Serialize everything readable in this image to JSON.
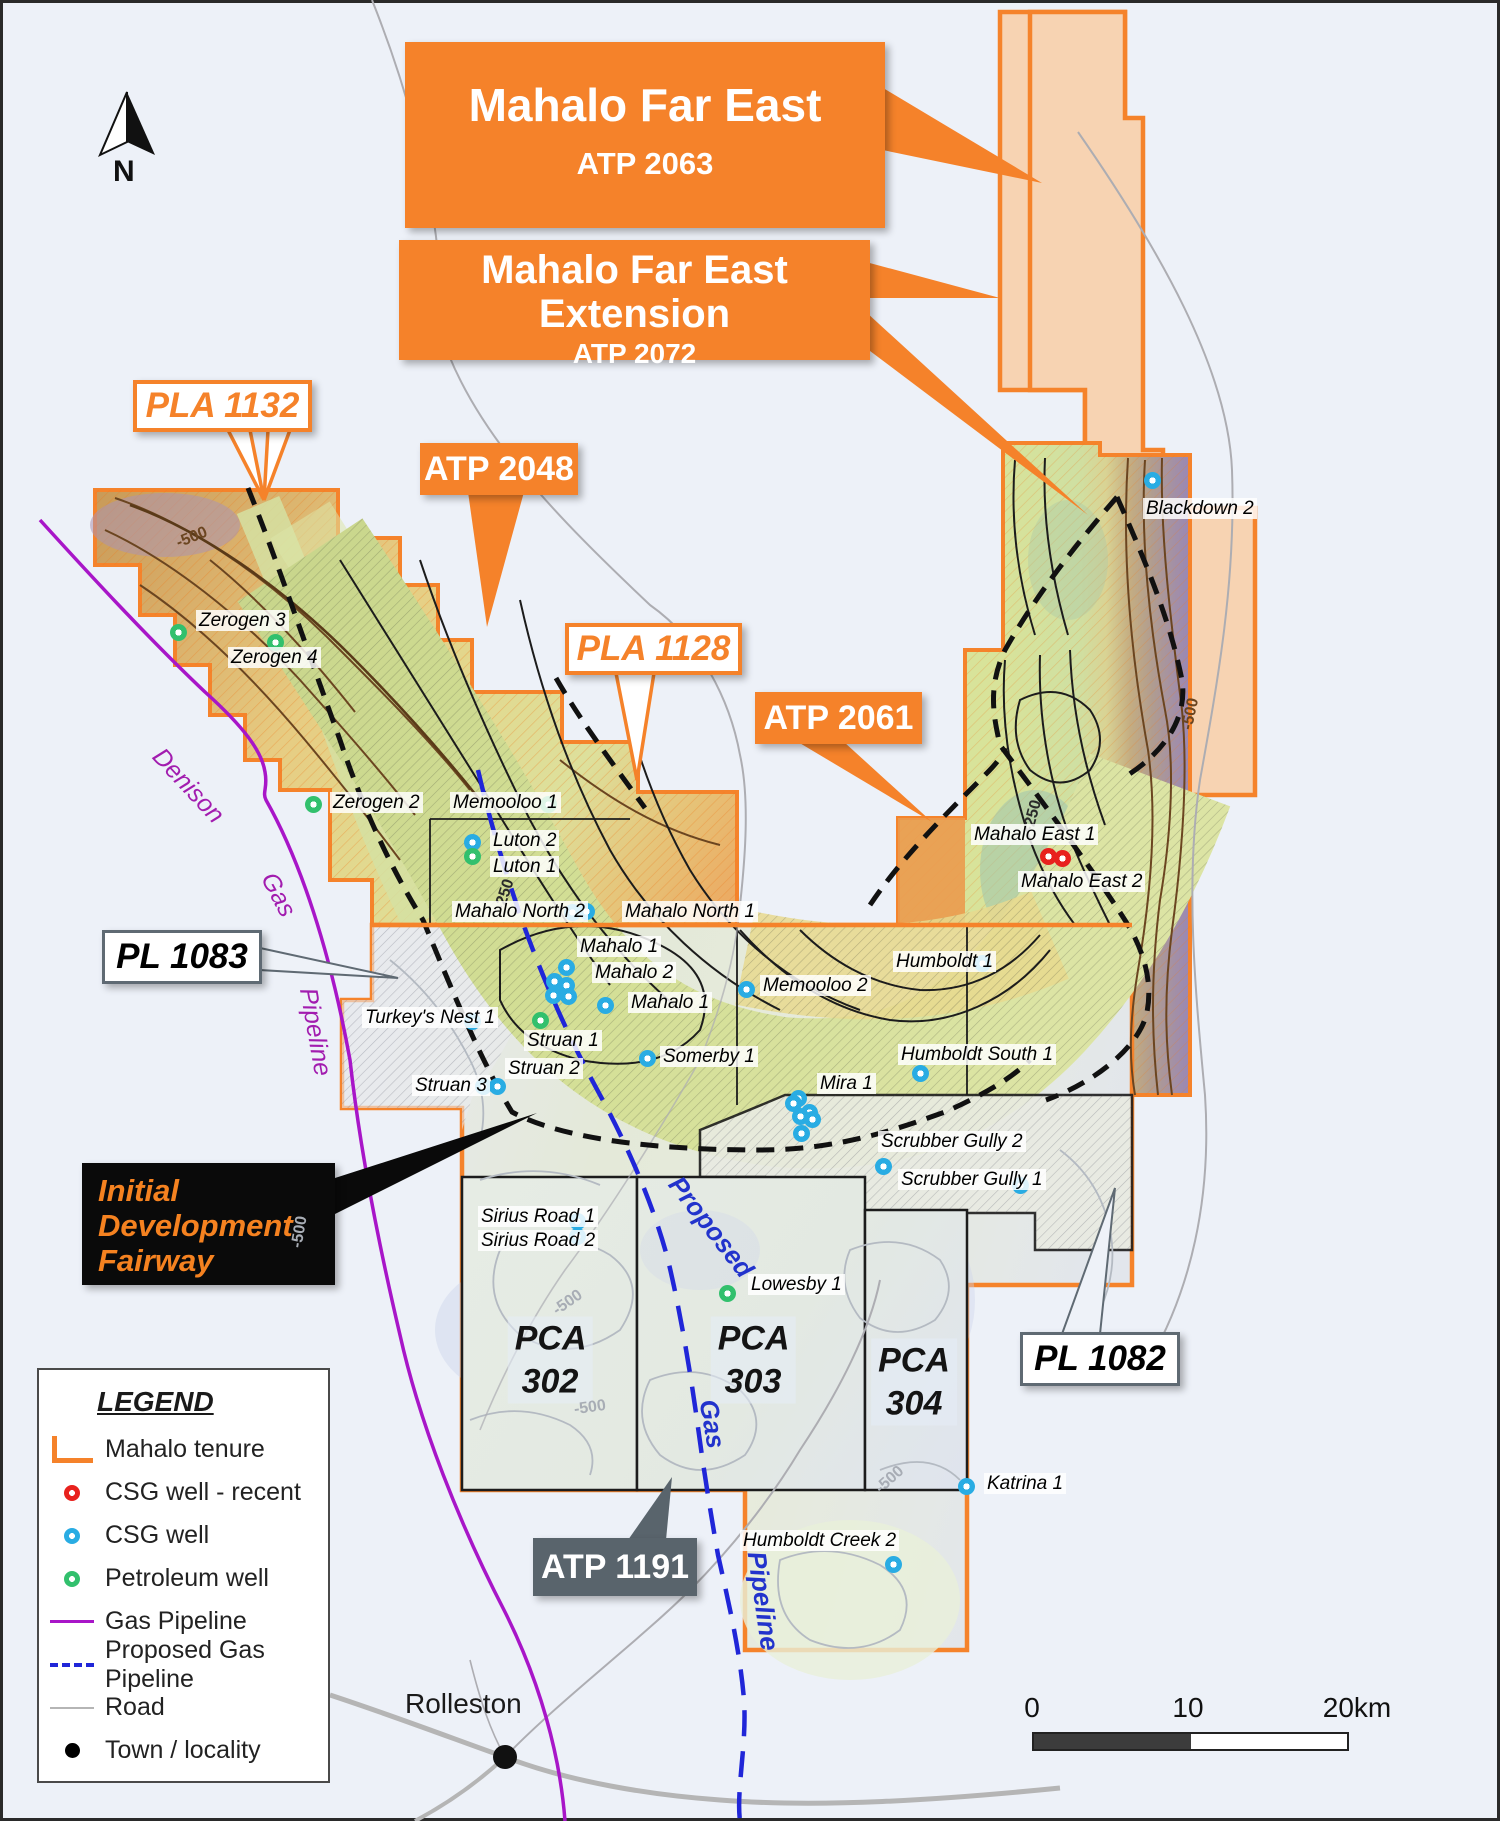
{
  "map": {
    "north_label": "N",
    "town": {
      "name": "Rolleston",
      "x": 505,
      "y": 1757,
      "label_x": 405,
      "label_y": 1688
    },
    "contour_labels": [
      {
        "text": "-500",
        "x": 192,
        "y": 538,
        "rot": -22,
        "color": "#6b4520"
      },
      {
        "text": "-250",
        "x": 505,
        "y": 895,
        "rot": -72,
        "color": "#2a2a2a"
      },
      {
        "text": "-250",
        "x": 1033,
        "y": 816,
        "rot": -75,
        "color": "#2a2a2a"
      },
      {
        "text": "-500",
        "x": 1191,
        "y": 714,
        "rot": -78,
        "color": "#6b4520"
      },
      {
        "text": "-500",
        "x": 568,
        "y": 1303,
        "rot": -35,
        "color": "#a8adb5"
      },
      {
        "text": "-500",
        "x": 590,
        "y": 1408,
        "rot": -8,
        "color": "#a8adb5"
      },
      {
        "text": "-500",
        "x": 890,
        "y": 1480,
        "rot": -42,
        "color": "#a8adb5"
      },
      {
        "text": "-500",
        "x": 300,
        "y": 1232,
        "rot": -80,
        "color": "#a8adb5"
      }
    ]
  },
  "callouts": {
    "mahalo_far_east": {
      "title": "Mahalo Far East",
      "code": "ATP 2063"
    },
    "mahalo_far_east_extension": {
      "title": "Mahalo Far East Extension",
      "code": "ATP 2072"
    },
    "atp_2048": {
      "label": "ATP 2048"
    },
    "pla_1132": {
      "label": "PLA 1132"
    },
    "pla_1128": {
      "label": "PLA 1128"
    },
    "atp_2061": {
      "label": "ATP 2061"
    },
    "pl_1083": {
      "label": "PL 1083"
    },
    "pl_1082": {
      "label": "PL 1082"
    },
    "atp_1191": {
      "label": "ATP 1191"
    },
    "initial_development_fairway": {
      "label": "Initial Development Fairway"
    }
  },
  "regions": [
    {
      "label": "PCA 302",
      "x": 550,
      "y": 1360
    },
    {
      "label": "PCA 303",
      "x": 753,
      "y": 1360
    },
    {
      "label": "PCA\n304",
      "x": 914,
      "y": 1382
    }
  ],
  "pipelines": {
    "denison": [
      {
        "text": "Denison",
        "x": 188,
        "y": 786,
        "rot": 47
      },
      {
        "text": "Gas",
        "x": 278,
        "y": 895,
        "rot": 62
      },
      {
        "text": "Pipeline",
        "x": 315,
        "y": 1032,
        "rot": 80
      }
    ],
    "proposed": [
      {
        "text": "Proposed",
        "x": 711,
        "y": 1227,
        "rot": 52
      },
      {
        "text": "Gas",
        "x": 712,
        "y": 1424,
        "rot": 80
      },
      {
        "text": "Pipeline",
        "x": 763,
        "y": 1601,
        "rot": 82
      }
    ]
  },
  "wells": {
    "markers": [
      {
        "t": "petroleum",
        "x": 178,
        "y": 632
      },
      {
        "t": "petroleum",
        "x": 275,
        "y": 642
      },
      {
        "t": "petroleum",
        "x": 313,
        "y": 804
      },
      {
        "t": "petroleum",
        "x": 548,
        "y": 804
      },
      {
        "t": "csg",
        "x": 472,
        "y": 842
      },
      {
        "t": "petroleum",
        "x": 472,
        "y": 856
      },
      {
        "t": "csg",
        "x": 572,
        "y": 912
      },
      {
        "t": "csg",
        "x": 586,
        "y": 911
      },
      {
        "t": "csg",
        "x": 566,
        "y": 967
      },
      {
        "t": "csg",
        "x": 554,
        "y": 981
      },
      {
        "t": "csg",
        "x": 566,
        "y": 985
      },
      {
        "t": "csg",
        "x": 553,
        "y": 995
      },
      {
        "t": "csg",
        "x": 568,
        "y": 996
      },
      {
        "t": "csg",
        "x": 605,
        "y": 1005
      },
      {
        "t": "petroleum",
        "x": 540,
        "y": 1020
      },
      {
        "t": "csg",
        "x": 472,
        "y": 1021
      },
      {
        "t": "csg",
        "x": 483,
        "y": 1086
      },
      {
        "t": "csg",
        "x": 497,
        "y": 1086
      },
      {
        "t": "csg",
        "x": 647,
        "y": 1058
      },
      {
        "t": "csg",
        "x": 746,
        "y": 989
      },
      {
        "t": "csg",
        "x": 982,
        "y": 963
      },
      {
        "t": "csg",
        "x": 920,
        "y": 1073
      },
      {
        "t": "csg",
        "x": 798,
        "y": 1098
      },
      {
        "t": "csg",
        "x": 793,
        "y": 1103
      },
      {
        "t": "csg",
        "x": 809,
        "y": 1112
      },
      {
        "t": "csg",
        "x": 800,
        "y": 1116
      },
      {
        "t": "csg",
        "x": 812,
        "y": 1119
      },
      {
        "t": "csg",
        "x": 801,
        "y": 1133
      },
      {
        "t": "csg",
        "x": 883,
        "y": 1166
      },
      {
        "t": "csg",
        "x": 1020,
        "y": 1185
      },
      {
        "t": "csg",
        "x": 577,
        "y": 1221
      },
      {
        "t": "csg",
        "x": 577,
        "y": 1236
      },
      {
        "t": "petroleum",
        "x": 727,
        "y": 1293
      },
      {
        "t": "csg",
        "x": 966,
        "y": 1486
      },
      {
        "t": "csg",
        "x": 893,
        "y": 1564
      },
      {
        "t": "csg_recent",
        "x": 1048,
        "y": 856
      },
      {
        "t": "csg_recent",
        "x": 1062,
        "y": 858
      },
      {
        "t": "csg",
        "x": 1152,
        "y": 480
      }
    ],
    "labels": [
      {
        "text": "Zerogen 3",
        "x": 196,
        "y": 610
      },
      {
        "text": "Zerogen 4",
        "x": 228,
        "y": 647
      },
      {
        "text": "Zerogen 2",
        "x": 330,
        "y": 792
      },
      {
        "text": "Memooloo 1",
        "x": 450,
        "y": 792
      },
      {
        "text": "Luton 2",
        "x": 490,
        "y": 830
      },
      {
        "text": "Luton 1",
        "x": 490,
        "y": 856
      },
      {
        "text": "Mahalo North 2",
        "x": 452,
        "y": 901
      },
      {
        "text": "Mahalo North 1",
        "x": 622,
        "y": 901
      },
      {
        "text": "Mahalo 1",
        "x": 577,
        "y": 936
      },
      {
        "text": "Mahalo 2",
        "x": 592,
        "y": 962
      },
      {
        "text": "Mahalo 1",
        "x": 628,
        "y": 992
      },
      {
        "text": "Struan 1",
        "x": 524,
        "y": 1030
      },
      {
        "text": "Struan 2",
        "x": 505,
        "y": 1058
      },
      {
        "text": "Struan 3",
        "x": 412,
        "y": 1075
      },
      {
        "text": "Turkey's Nest 1",
        "x": 362,
        "y": 1007
      },
      {
        "text": "Somerby 1",
        "x": 660,
        "y": 1046
      },
      {
        "text": "Memooloo 2",
        "x": 760,
        "y": 975
      },
      {
        "text": "Humboldt 1",
        "x": 893,
        "y": 951
      },
      {
        "text": "Humboldt South 1",
        "x": 898,
        "y": 1044
      },
      {
        "text": "Mira 1",
        "x": 817,
        "y": 1073
      },
      {
        "text": "Scrubber Gully 2",
        "x": 878,
        "y": 1131
      },
      {
        "text": "Scrubber Gully 1",
        "x": 898,
        "y": 1169
      },
      {
        "text": "Sirius Road 1",
        "x": 478,
        "y": 1206
      },
      {
        "text": "Sirius Road 2",
        "x": 478,
        "y": 1230
      },
      {
        "text": "Lowesby 1",
        "x": 748,
        "y": 1274
      },
      {
        "text": "Katrina 1",
        "x": 984,
        "y": 1473
      },
      {
        "text": "Humboldt Creek 2",
        "x": 740,
        "y": 1530
      },
      {
        "text": "Mahalo East 1",
        "x": 971,
        "y": 824
      },
      {
        "text": "Mahalo East 2",
        "x": 1018,
        "y": 871
      },
      {
        "text": "Blackdown 2",
        "x": 1143,
        "y": 498
      }
    ]
  },
  "legend": {
    "title": "LEGEND",
    "items": [
      {
        "icon": "tenure-line",
        "label": "Mahalo tenure"
      },
      {
        "icon": "well-red",
        "label": "CSG well - recent"
      },
      {
        "icon": "well-blue",
        "label": "CSG well"
      },
      {
        "icon": "well-green",
        "label": "Petroleum well"
      },
      {
        "icon": "line-purple",
        "label": "Gas Pipeline"
      },
      {
        "icon": "dash-blue",
        "label": "Proposed Gas Pipeline"
      },
      {
        "icon": "line-gray",
        "label": "Road"
      },
      {
        "icon": "dot-black",
        "label": "Town / locality"
      }
    ]
  },
  "scalebar": {
    "labels": [
      "0",
      "10",
      "20km"
    ]
  },
  "colors": {
    "accent_orange": "#f5822a",
    "csg": "#29ace3",
    "csg_recent": "#e8211d",
    "petroleum": "#32c06d",
    "gas_pipeline": "#a816c8",
    "proposed_pipeline": "#2026d8",
    "road": "#b0b0b5",
    "town": "#111111"
  }
}
